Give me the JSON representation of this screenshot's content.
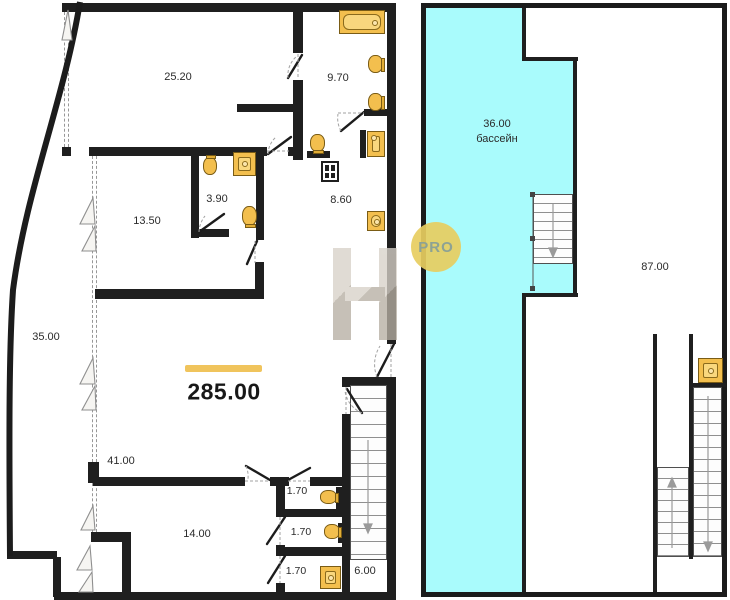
{
  "plan": {
    "labels": {
      "room_25_20": "25.20",
      "room_9_70": "9.70",
      "room_3_90": "3.90",
      "room_8_60": "8.60",
      "room_13_50": "13.50",
      "terrace_35": "35.00",
      "total_area": "285.00",
      "room_41": "41.00",
      "room_14": "14.00",
      "wc_1": "1.70",
      "wc_2": "1.70",
      "wc_3": "1.70",
      "stair_6": "6.00",
      "pool_area": "36.00",
      "pool_name": "бассейн",
      "hall_87": "87.00"
    },
    "watermark": {
      "letter": "H",
      "badge": "PRO"
    },
    "colors": {
      "wall": "#1f1f1f",
      "pool": "#a9fbfc",
      "fixture": "#f3bf4e",
      "accent_bar": "#f0c45c"
    }
  }
}
